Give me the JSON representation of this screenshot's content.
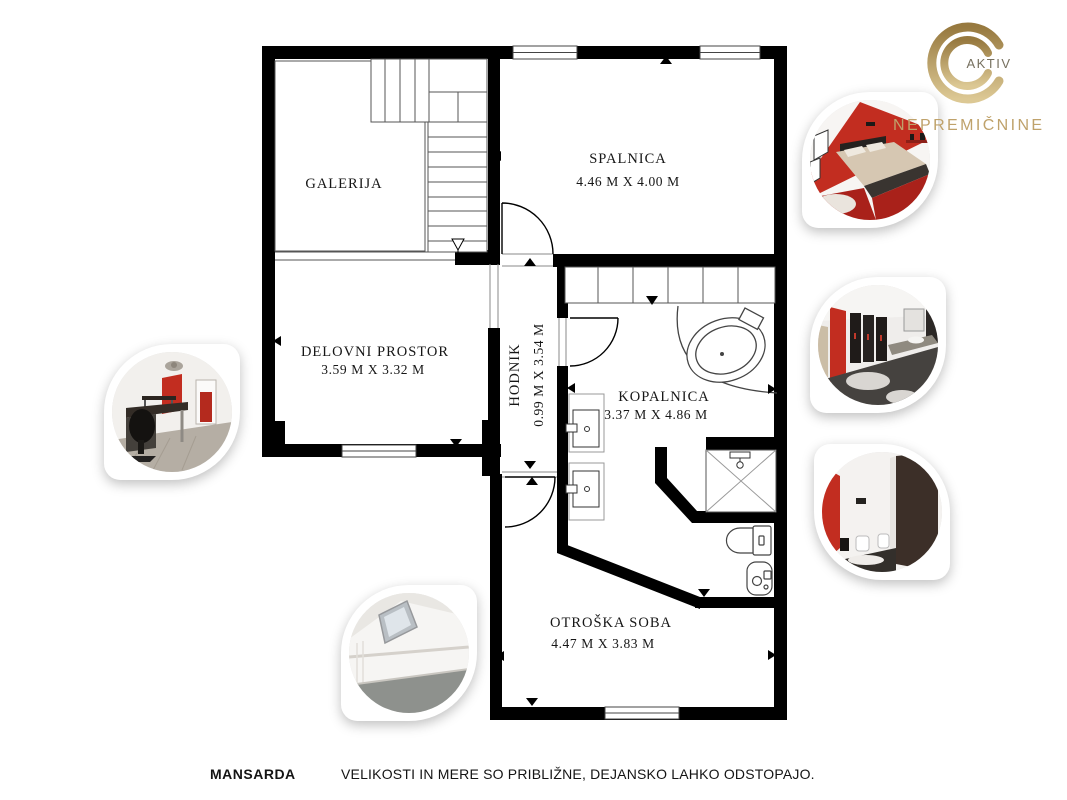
{
  "brand": {
    "name": "AKTIV",
    "subtitle": "NEPREMIČNINE",
    "gold": "#b3945e"
  },
  "floor_plan": {
    "rooms": [
      {
        "name": "GALERIJA",
        "dims": ""
      },
      {
        "name": "SPALNICA",
        "dims": "4.46 M X 4.00 M"
      },
      {
        "name": "DELOVNI PROSTOR",
        "dims": "3.59 M X 3.32 M"
      },
      {
        "name": "HODNIK",
        "dims": "0.99 M X 3.54 M"
      },
      {
        "name": "KOPALNICA",
        "dims": "3.37 M X 4.86 M"
      },
      {
        "name": "OTROŠKA SOBA",
        "dims": "4.47 M X 3.83 M"
      }
    ],
    "fixtures": [
      "stairs",
      "wardrobe",
      "corner-bathtub",
      "sink",
      "sink",
      "shower",
      "toilet",
      "bidet"
    ]
  },
  "photos": [
    "red-bedroom",
    "dark-bathroom",
    "wc-room",
    "office",
    "attic-room"
  ],
  "footer": {
    "floor": "MANSARDA",
    "note": "VELIKOSTI IN MERE SO PRIBLIŽNE, DEJANSKO LAHKO ODSTOPAJO."
  },
  "colors": {
    "accent_red": "#c22d20",
    "wall": "#000000",
    "gold": "#b3945e"
  }
}
